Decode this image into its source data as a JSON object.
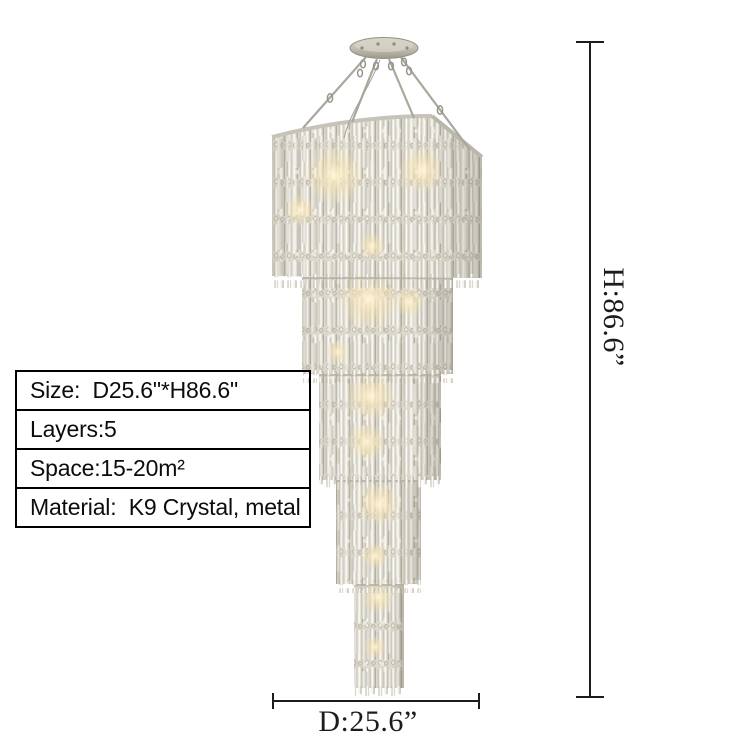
{
  "page": {
    "background": "#ffffff",
    "description": "product dimension image of a 5-layer crystal chandelier"
  },
  "spec_table": {
    "rows": [
      "Size:  D25.6\"*H86.6\"",
      "Layers:5",
      "Space:15-20m²",
      "Material:  K9 Crystal, metal"
    ]
  },
  "dimensions": {
    "height_label": "H:86.6”",
    "diameter_label": "D:25.6”"
  },
  "theme": {
    "background": "#ffffff",
    "line_color": "#1c1c1c",
    "text_color": "#0c0c0c",
    "table_border_color": "#000000",
    "crystal_light": "#f6f5ef",
    "crystal_mid": "#cdc9bb",
    "crystal_dark": "#a8a496",
    "metal_color": "#b3afa3",
    "glow_color": "#f6e3b2"
  }
}
